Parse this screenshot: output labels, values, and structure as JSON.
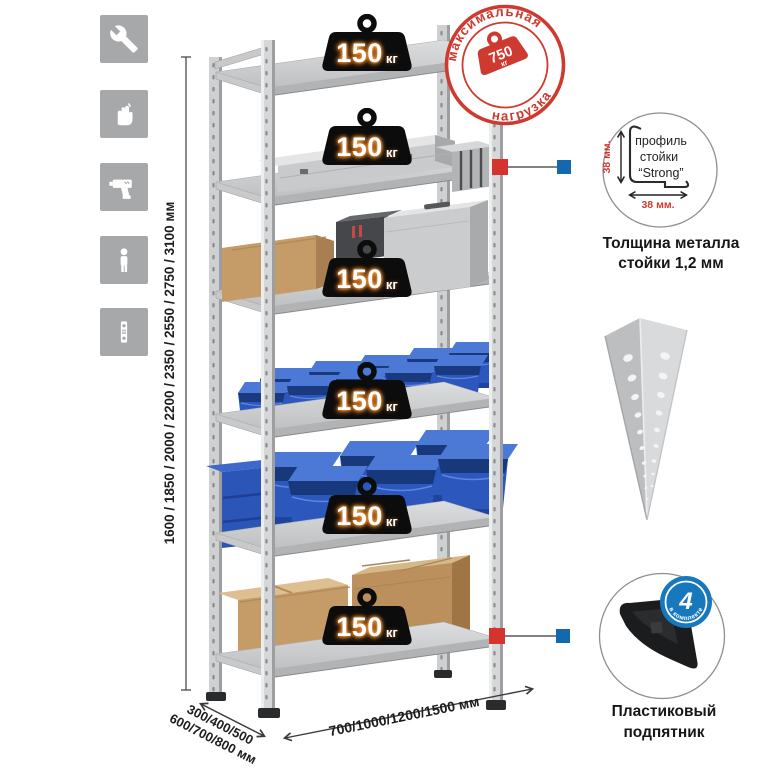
{
  "legend_icons": [
    {
      "name": "wrench"
    },
    {
      "name": "gloves"
    },
    {
      "name": "drill"
    },
    {
      "name": "person-height"
    },
    {
      "name": "mounting-strip"
    }
  ],
  "shelves": {
    "unit": "кг",
    "loads": [
      "150",
      "150",
      "150",
      "150",
      "150",
      "150"
    ]
  },
  "stamp": {
    "arc_top": "максимальная",
    "arc_bottom": "нагрузка",
    "value": "750",
    "unit": "кг"
  },
  "dimensions": {
    "height_range": "1600 / 1850 / 2000 / 2200 / 2350 / 2550 / 2750 / 3100 мм",
    "depth_line1": "300/400/500",
    "depth_line2": "600/700/800 мм",
    "width_range": "700/1000/1200/1500 мм"
  },
  "profile_detail": {
    "label_line1": "профиль",
    "label_line2": "стойки",
    "label_line3": "“Strong”",
    "dim_vertical": "38 мм.",
    "dim_horizontal": "38 мм.",
    "caption_line1": "Толщина металла",
    "caption_line2": "стойки 1,2 мм"
  },
  "foot_detail": {
    "badge_value": "4",
    "badge_arc_text": "в комплекте",
    "caption_line1": "Пластиковый",
    "caption_line2": "подпятник"
  },
  "colors": {
    "accent_red": "#cf3a30",
    "marker_blue": "#1468b0",
    "bin_blue": "#2c57bd",
    "icon_gray": "#a7a8aa"
  }
}
